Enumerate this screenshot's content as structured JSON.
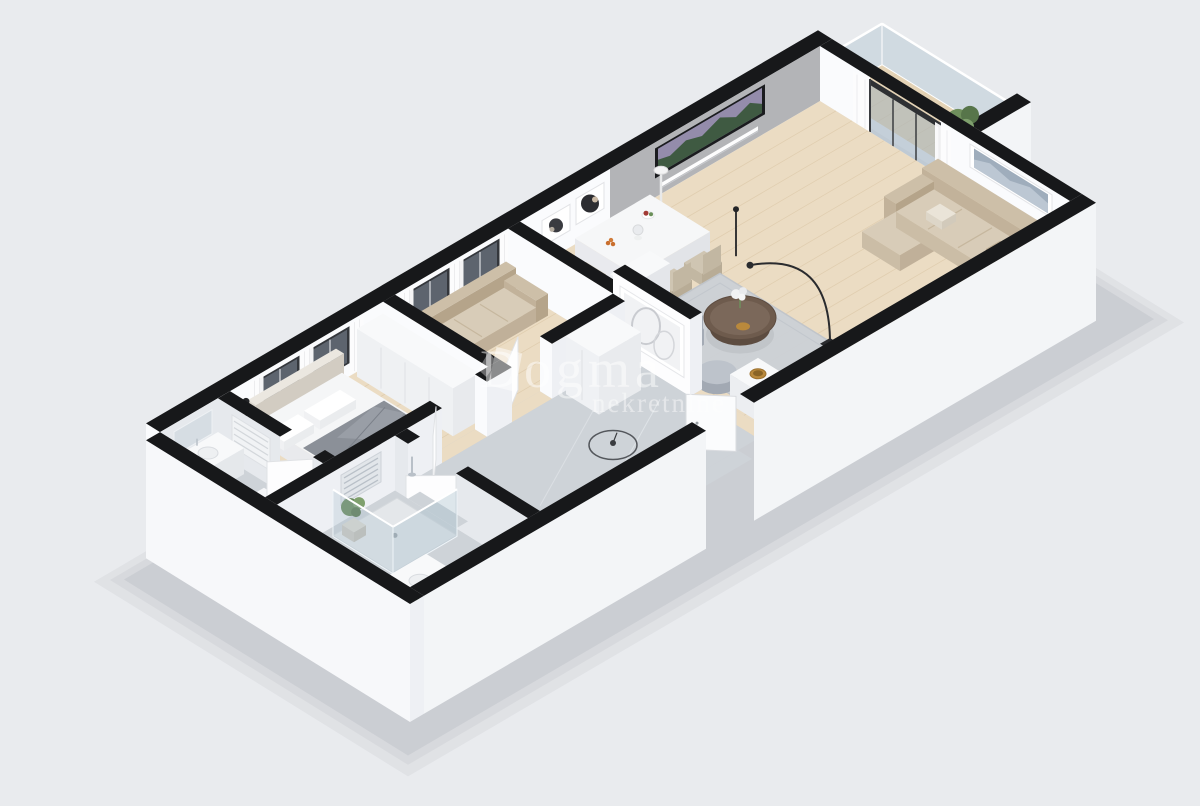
{
  "scene": {
    "type": "3d-isometric-floorplan-render",
    "description": "Real-estate 3D floor plan render of a one-bedroom apartment, viewed isometrically on a plain light background",
    "background": "#e9ebee",
    "shadow": "#3a4252"
  },
  "watermark": {
    "brand": "Dogma",
    "tagline": "nekretnine",
    "logo_icon": "dogma-logo",
    "color": "#ffffff"
  },
  "palette": {
    "wall_cap": "#17181a",
    "face_white": "#fafbfd",
    "face_shade": "#eef0f4",
    "exterior": "#f3f5f7",
    "exterior_bright": "#f7f8fa",
    "accent_gray": "#b3b4b7",
    "wood": "#ebdcc3",
    "plank": "#dcc8a8",
    "wood_balcony": "#e4d3b6",
    "marble_floor": "#ced3d8",
    "marble_wall": "#e6e9ed",
    "glass": "rgba(168,192,206,0.38)",
    "door_glass": "rgba(150,172,190,0.45)",
    "frame_dark": "#34373c",
    "tv_dark": "#1b1c1f",
    "tv_sky": "#948cab",
    "tv_mountain": "#3f5a42",
    "sofa_back": "#cdbfa8",
    "sofa_side": "#b5a48a",
    "sofa_seat": "#d8ccb8",
    "bed_white": "#f5f6f7",
    "throw_gray": "#8b9098",
    "rug": "#cdd1d6",
    "chair": "#cfc5b2",
    "armchair": "#bcc2ca",
    "white_furn": "#f8f9fa",
    "wood_dark": "#6e5b4d",
    "gold": "#b9893c",
    "green": "#6f8f5c",
    "green_dark": "#57754a",
    "chrome": "#b9c0c8",
    "black": "#232427"
  },
  "rooms": [
    {
      "name": "balcony",
      "items": [
        "glass-balustrade",
        "potted-plant"
      ]
    },
    {
      "name": "living-room",
      "items": [
        "sliding-glass-door",
        "curtains",
        "tv",
        "tv-console",
        "wall-art",
        "sofa",
        "dining-table",
        "dining-chairs",
        "fruit-bowl",
        "flower-vase",
        "bookshelf",
        "floor-lamp",
        "arc-floor-lamp",
        "area-rug",
        "coffee-table",
        "armchair",
        "pouf",
        "side-table",
        "gold-bowl",
        "art-frames"
      ]
    },
    {
      "name": "study-room",
      "items": [
        "windows",
        "curtains",
        "sofa",
        "door"
      ]
    },
    {
      "name": "hallway",
      "items": [
        "ceiling-lamp",
        "tall-cabinet",
        "entry-door",
        "partition-art-wall",
        "marble-floor"
      ]
    },
    {
      "name": "bedroom",
      "items": [
        "double-bed",
        "pillows",
        "gray-throw",
        "headboard",
        "wardrobe",
        "windows",
        "curtains",
        "floor-lamp",
        "door"
      ]
    },
    {
      "name": "bathroom",
      "items": [
        "towel-radiator",
        "vanity",
        "sink",
        "mirror",
        "toilet",
        "washing-machine",
        "door"
      ]
    },
    {
      "name": "shower-room",
      "items": [
        "glass-shower",
        "shower-tray",
        "potted-plant",
        "vanity",
        "sink",
        "towel-radiator",
        "door"
      ]
    }
  ]
}
